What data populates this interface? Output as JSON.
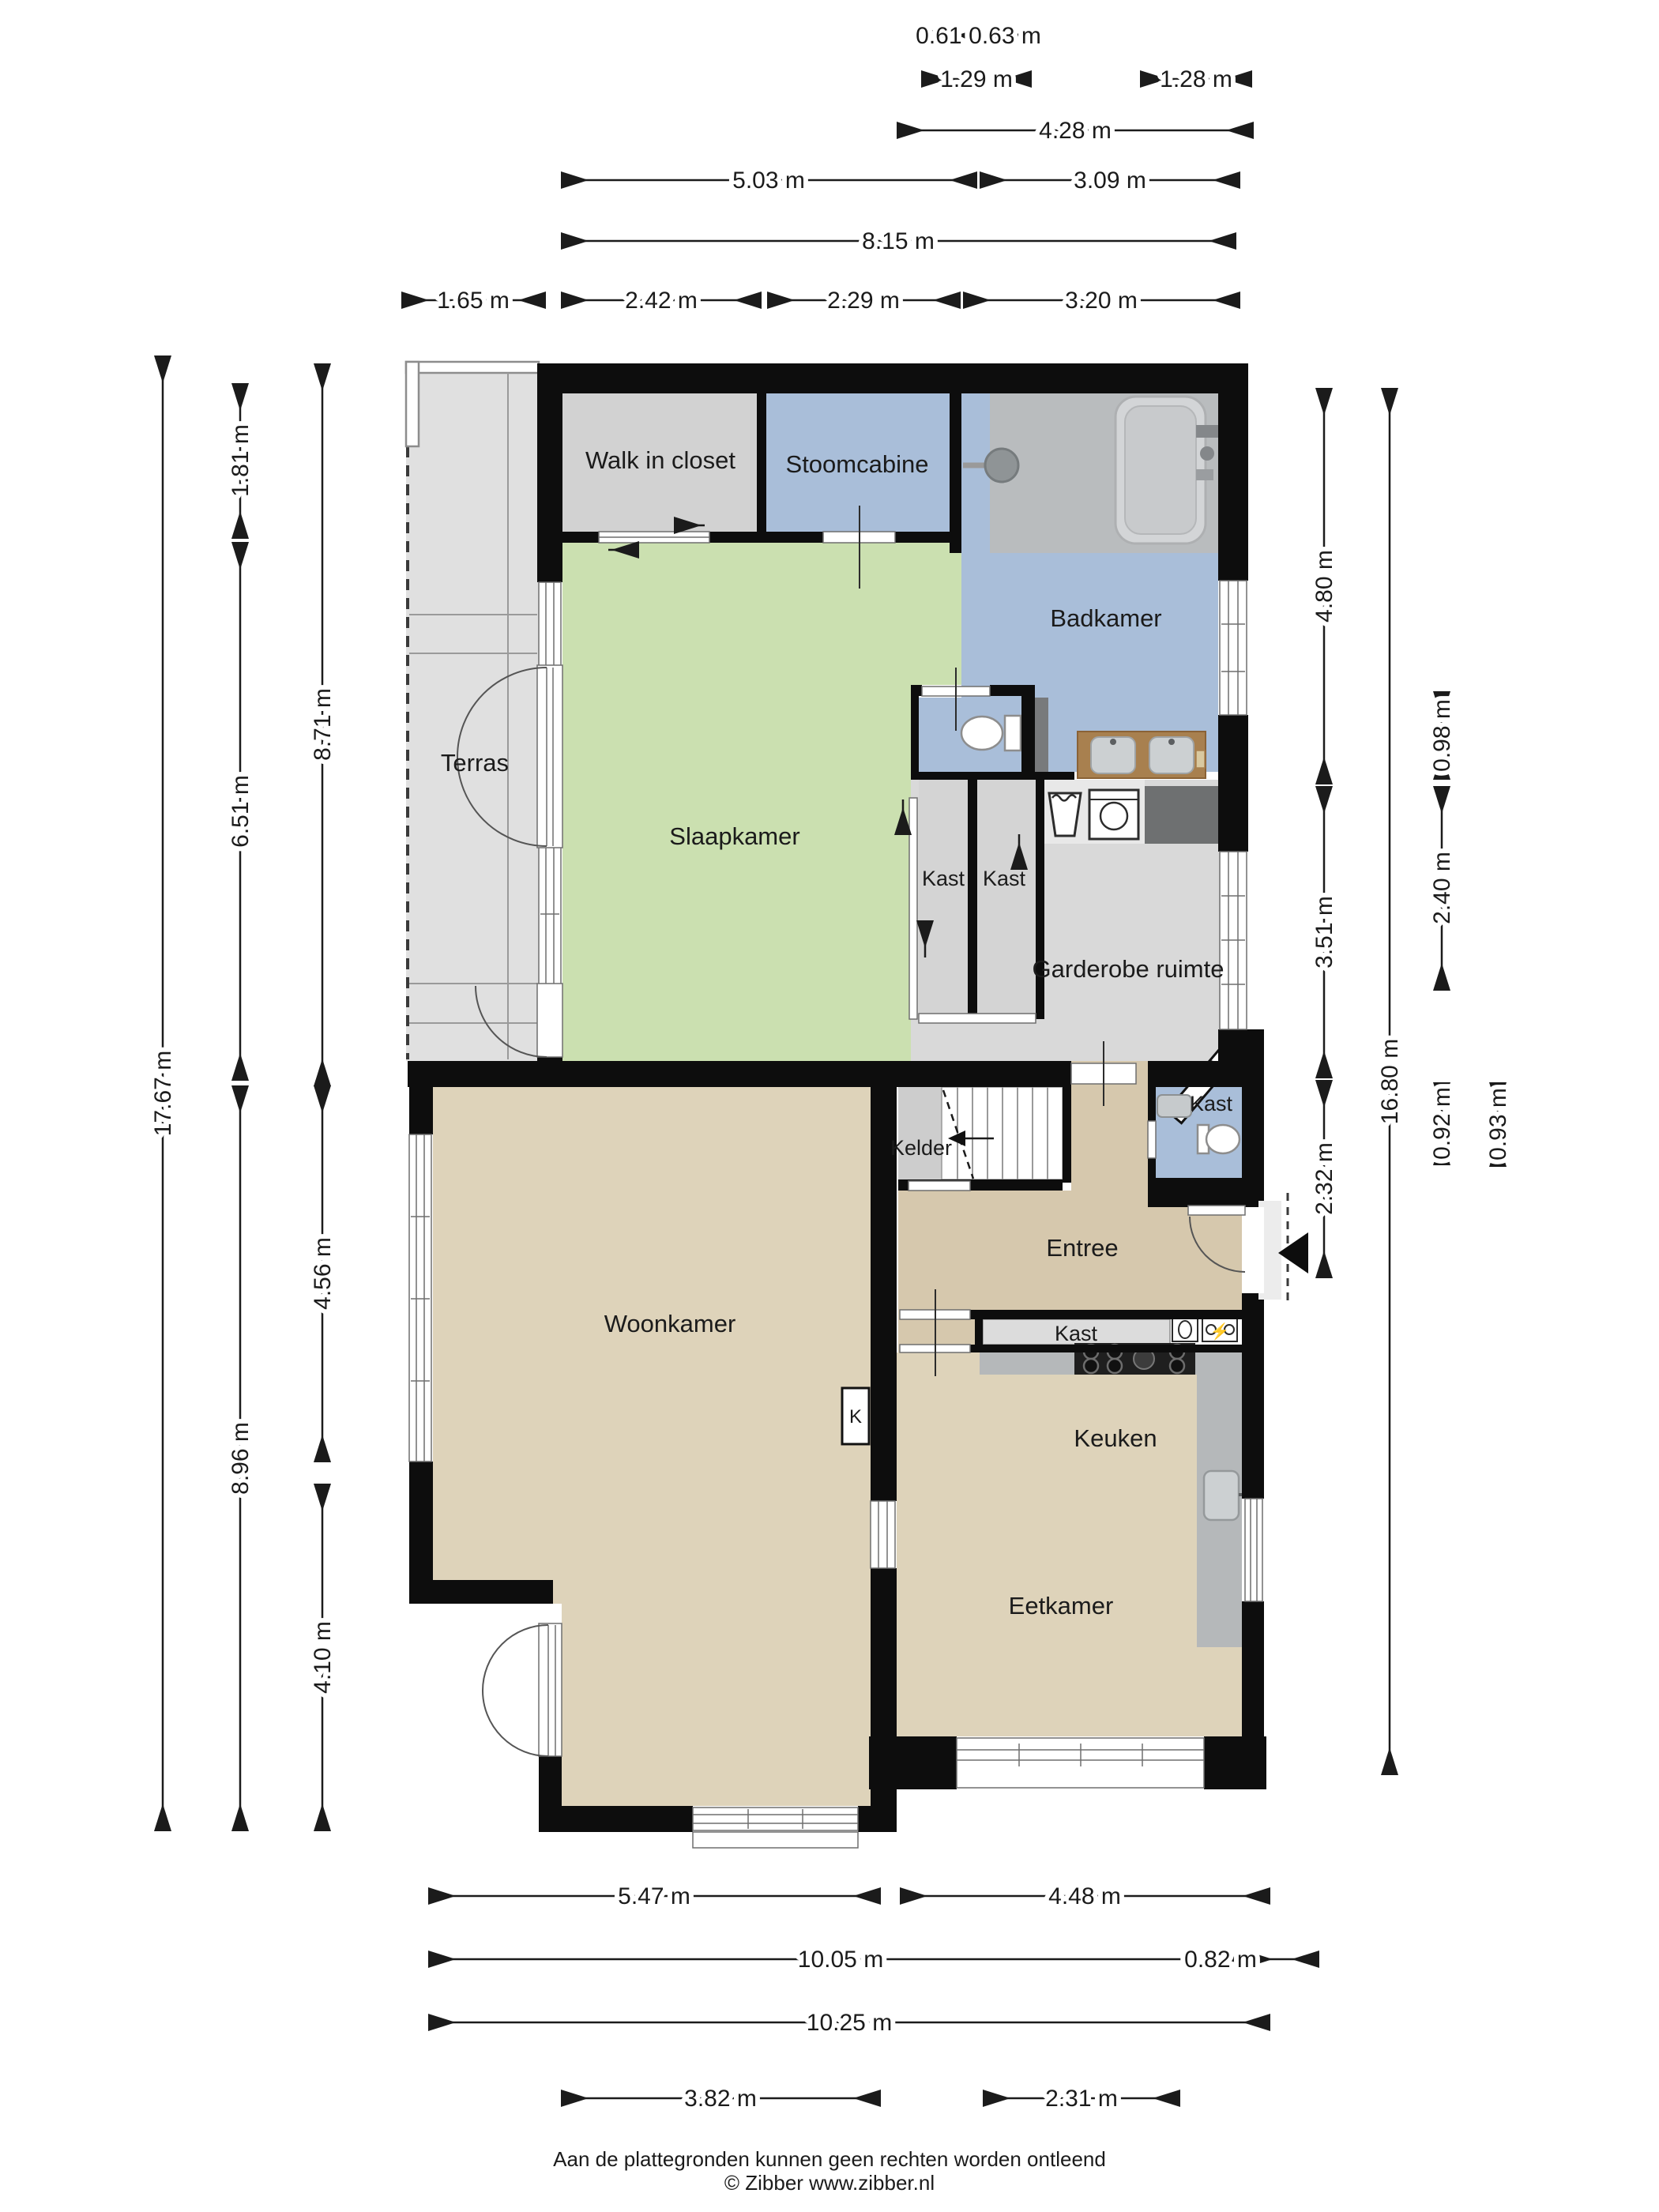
{
  "document": {
    "type": "floor-plan",
    "language": "nl",
    "footer_line1": "Aan de plattegronden kunnen geen rechten worden ontleend",
    "footer_line2": "© Zibber www.zibber.nl"
  },
  "rooms": {
    "walk_in_closet": {
      "label": "Walk in closet"
    },
    "stoomcabine": {
      "label": "Stoomcabine"
    },
    "badkamer": {
      "label": "Badkamer"
    },
    "terras": {
      "label": "Terras"
    },
    "slaapkamer": {
      "label": "Slaapkamer"
    },
    "kast_1": {
      "label": "Kast"
    },
    "kast_2": {
      "label": "Kast"
    },
    "garderobe": {
      "label": "Garderobe ruimte"
    },
    "kast_diagonaal": {
      "label": "Kast"
    },
    "kelder": {
      "label": "Kelder"
    },
    "entree": {
      "label": "Entree"
    },
    "kast_hal": {
      "label": "Kast"
    },
    "woonkamer": {
      "label": "Woonkamer"
    },
    "kast_k": {
      "label": "K"
    },
    "keuken": {
      "label": "Keuken"
    },
    "eetkamer": {
      "label": "Eetkamer"
    }
  },
  "dimensions": {
    "top": [
      {
        "label": "0.61 m"
      },
      {
        "label": "0.63 m"
      },
      {
        "label": "1.29 m"
      },
      {
        "label": "1.28 m"
      },
      {
        "label": "4.28 m"
      },
      {
        "label": "5.03 m"
      },
      {
        "label": "3.09 m"
      },
      {
        "label": "8.15 m"
      },
      {
        "label": "1.65 m"
      },
      {
        "label": "2.42 m"
      },
      {
        "label": "2.29 m"
      },
      {
        "label": "3.20 m"
      }
    ],
    "left": [
      {
        "label": "17.67 m"
      },
      {
        "label": "1.81 m"
      },
      {
        "label": "6.51 m"
      },
      {
        "label": "8.96 m"
      },
      {
        "label": "8.71 m"
      },
      {
        "label": "4.56 m"
      },
      {
        "label": "4.10 m"
      }
    ],
    "right": [
      {
        "label": "4.80 m"
      },
      {
        "label": "3.51 m"
      },
      {
        "label": "2.32 m"
      },
      {
        "label": "16.80 m"
      },
      {
        "label": "0.98 m"
      },
      {
        "label": "2.40 m"
      },
      {
        "label": "0.92 m"
      },
      {
        "label": "0.93 m"
      }
    ],
    "bottom": [
      {
        "label": "5.47 m"
      },
      {
        "label": "4.48 m"
      },
      {
        "label": "10.05 m"
      },
      {
        "label": "0.82 m"
      },
      {
        "label": "10.25 m"
      },
      {
        "label": "3.82 m"
      },
      {
        "label": "2.31 m"
      }
    ]
  },
  "icons": [
    "bathtub-icon",
    "shower-icon",
    "toilet-icon",
    "double-sink-icon",
    "sink-icon",
    "washing-machine-icon",
    "handwash-icon",
    "stair-icon",
    "stove-icon",
    "kitchen-sink-icon",
    "lamp-icon",
    "electric-meter-icon",
    "entrance-arrow-icon"
  ],
  "colors": {
    "wall": "#0d0d0d",
    "bedroom_green": "#cbe0b0",
    "bathroom_blue": "#a9bed9",
    "living_tan": "#ded3ba",
    "entree_tan": "#d6c8ad",
    "terrace_gray": "#e0e0e0",
    "closet_gray": "#d2d2d2",
    "wardrobe_gray": "#d9d9d9",
    "cellar_gray": "#cdcdcd",
    "counter_gray": "#b5b8ba",
    "dark_counter": "#6e7071",
    "vanity_brown": "#a8804f",
    "hob_black": "#1f1f1f"
  }
}
